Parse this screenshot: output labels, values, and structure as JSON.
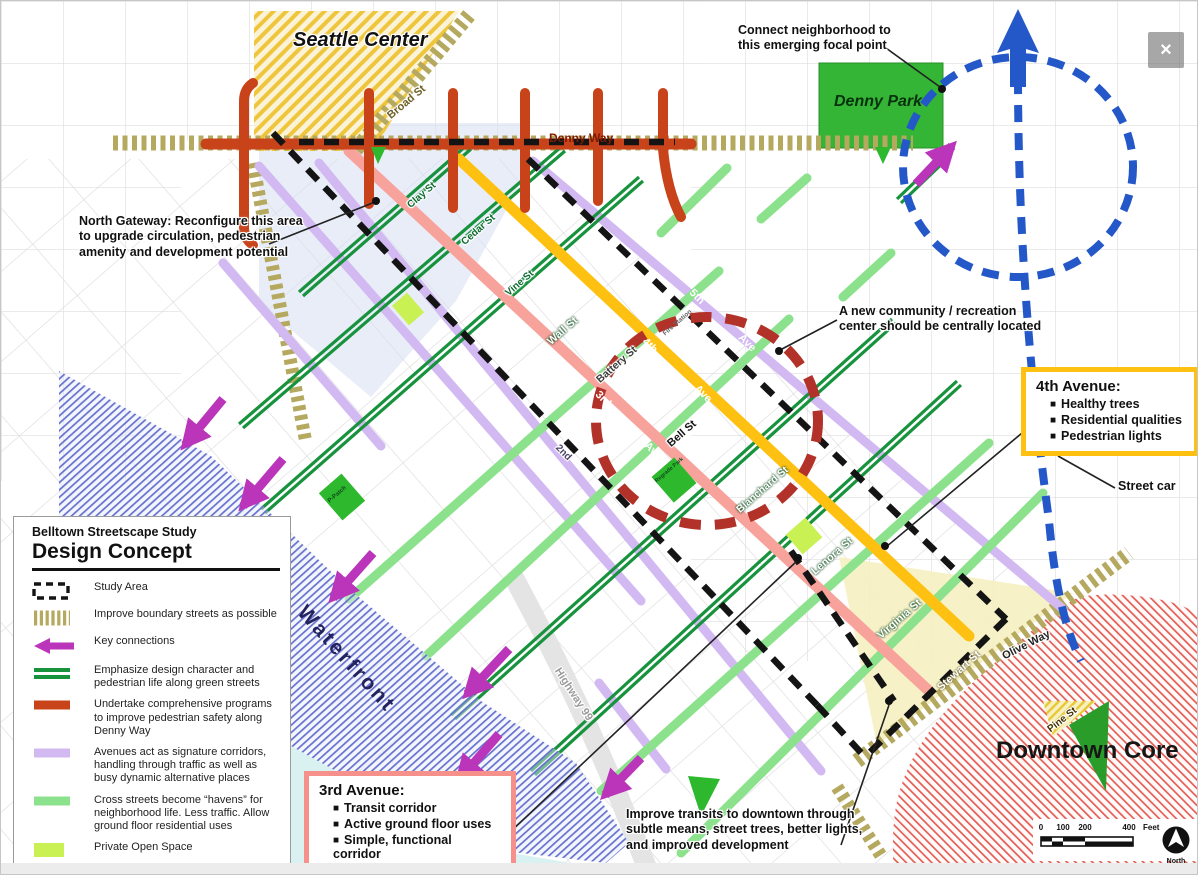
{
  "window": {
    "close_glyph": "×"
  },
  "areas": {
    "seattle_center": "Seattle Center",
    "denny_park": "Denny Park",
    "waterfront": "Waterfront",
    "downtown_core": "Downtown Core"
  },
  "streets": {
    "denny_way": "Denny Way",
    "broad": "Broad St",
    "clay": "Clay St",
    "cedar": "Cedar St",
    "vine": "Vine St",
    "wall": "Wall St",
    "battery": "Battery St",
    "bell": "Bell St",
    "blanchard": "Blanchard St",
    "lenora": "Lenora St",
    "virginia": "Virginia St",
    "stewart": "Stewart St",
    "olive": "Olive Way",
    "pine": "Pine St",
    "highway99": "Highway 99",
    "ave2": "2nd",
    "ave3": "3rd",
    "ave4": "4th",
    "ave5": "5th",
    "ave_suffix": "Ave",
    "fire_station": "Fire Station",
    "regrade_park": "Regrade Park",
    "p_patch": "P-Patch"
  },
  "annotations": {
    "north_gateway": {
      "lines": [
        "North Gateway: Reconfigure this area",
        "to upgrade circulation, pedestrian",
        "amenity and development potential"
      ]
    },
    "connect_neighborhood": {
      "lines": [
        "Connect neighborhood to",
        "this emerging focal point"
      ]
    },
    "community_center": {
      "lines": [
        "A new community / recreation",
        "center should be centrally located"
      ]
    },
    "street_car": {
      "label": "Street car"
    },
    "improve_transits": {
      "lines": [
        "Improve transits to downtown through",
        "subtle means, street trees, better lights,",
        "and improved development"
      ]
    }
  },
  "callouts": {
    "bullet_char": "■",
    "fourth_avenue": {
      "title": "4th Avenue:",
      "bullets": [
        "Healthy trees",
        "Residential qualities",
        "Pedestrian lights"
      ]
    },
    "third_avenue": {
      "title": "3rd Avenue:",
      "bullets": [
        "Transit corridor",
        "Active ground floor uses",
        "Simple, functional corridor"
      ]
    }
  },
  "legend": {
    "subtitle": "Belltown Streetscape Study",
    "title": "Design Concept",
    "items": [
      {
        "key": "study-area",
        "label": "Study Area"
      },
      {
        "key": "boundary-streets",
        "label": "Improve boundary streets as possible"
      },
      {
        "key": "key-connections",
        "label": "Key connections"
      },
      {
        "key": "green-streets",
        "label": "Emphasize design character and pedestrian life along green streets"
      },
      {
        "key": "denny-way-programs",
        "label": "Undertake comprehensive programs to improve pedestrian safety along Denny Way"
      },
      {
        "key": "signature-avenues",
        "label": "Avenues act as signature corridors, handling through traffic as well as busy dynamic alternative places"
      },
      {
        "key": "cross-street-havens",
        "label": "Cross streets become “havens” for neighborhood life.  Less traffic. Allow ground floor residential uses"
      },
      {
        "key": "private-open-space",
        "label": "Private Open Space"
      },
      {
        "key": "public-open-space",
        "label": "Public Open Space"
      }
    ]
  },
  "scale_bar": {
    "ticks": [
      "0",
      "100",
      "200",
      "400"
    ],
    "unit": "Feet",
    "north_label": "North"
  },
  "colors": {
    "denny_red": "#c8431a",
    "green_street": "#17923d",
    "haven_green": "#8ce28c",
    "avenue_lavender": "#d2b9f2",
    "third_pink": "#f8a29c",
    "fourth_yellow": "#fec111",
    "key_connection_magenta": "#ba35ba",
    "streetcar_blue": "#2458c8",
    "study_dash_black": "#141414",
    "boundary_tan": "#b5a85f",
    "private_open_space": "#c9f153",
    "public_open_space": "#2eb82e",
    "community_circle_red": "#b23128"
  }
}
